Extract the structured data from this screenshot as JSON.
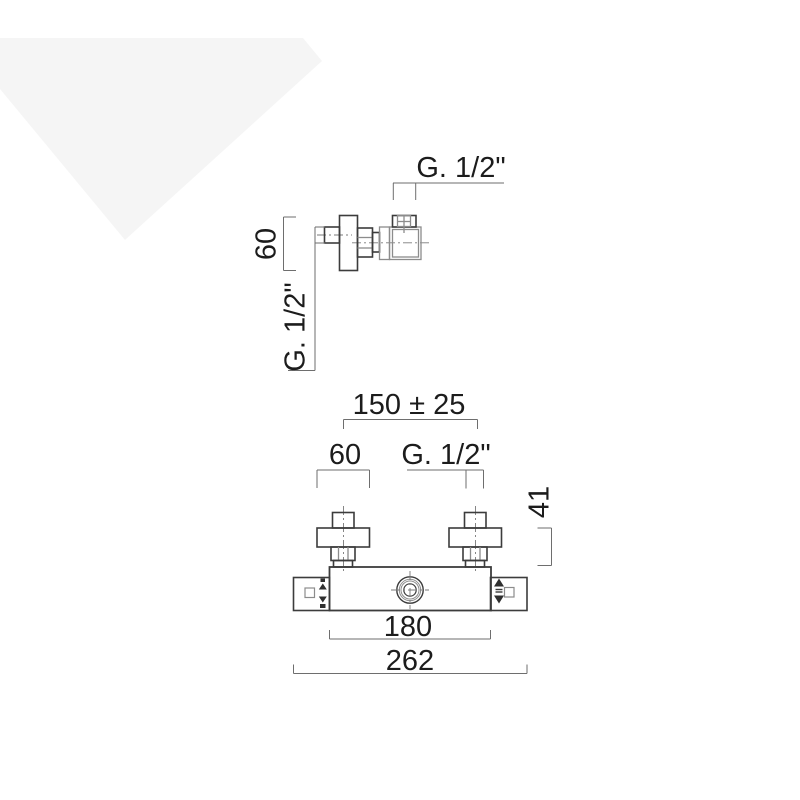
{
  "page": {
    "background": "#ffffff",
    "watermark_color": "#f5f5f5",
    "object_line_color": "#3c3c3c",
    "secondary_line_color": "#8c8c8c",
    "dimension_line_color": "#6e6e6e",
    "text_color": "#1c1c1c"
  },
  "labels": {
    "side_outlet_thread": "G. 1/2\"",
    "side_flange_height": "60",
    "side_inlet_thread": "G. 1/2\"",
    "front_center_distance": "150 ± 25",
    "front_flange_width": "60",
    "front_inlet_thread": "G. 1/2\"",
    "front_union_height": "41",
    "front_body_width": "180",
    "front_total_width": "262"
  }
}
